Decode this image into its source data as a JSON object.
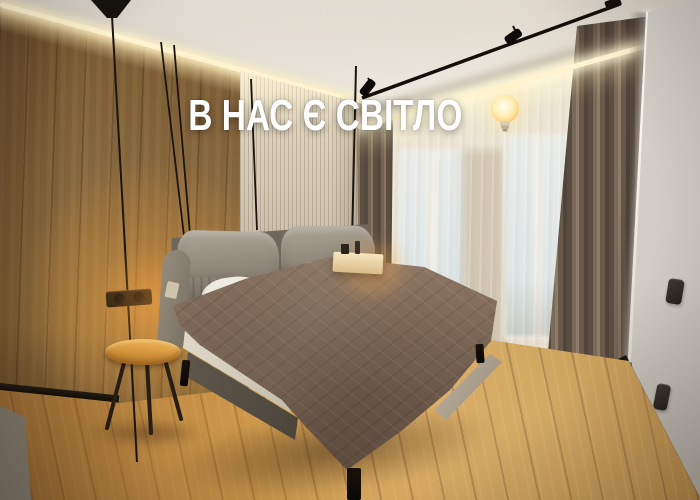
{
  "overlay": {
    "text": "В НАС Є СВІТЛО",
    "emoji": "💡",
    "emoji_name": "light-bulb"
  },
  "palette": {
    "caption": "#ffffff",
    "led_glow": "#fff4cf",
    "lamp_glow_soft": "rgba(255,175,75,.5)",
    "ceiling": "#e5e0d5",
    "wood_wall": "#8a6a3f",
    "ribbed_panel": "#d0c6b2",
    "sheer_curtain": "#eae2d1",
    "brown_curtain": "#7a6858",
    "wall_white": "#f0ede6",
    "floor": "#cc9a4e",
    "blanket": "#9a8271",
    "headboard": "#948b7d",
    "pillow": "#f3f0e8",
    "table_top": "#d2933c"
  }
}
